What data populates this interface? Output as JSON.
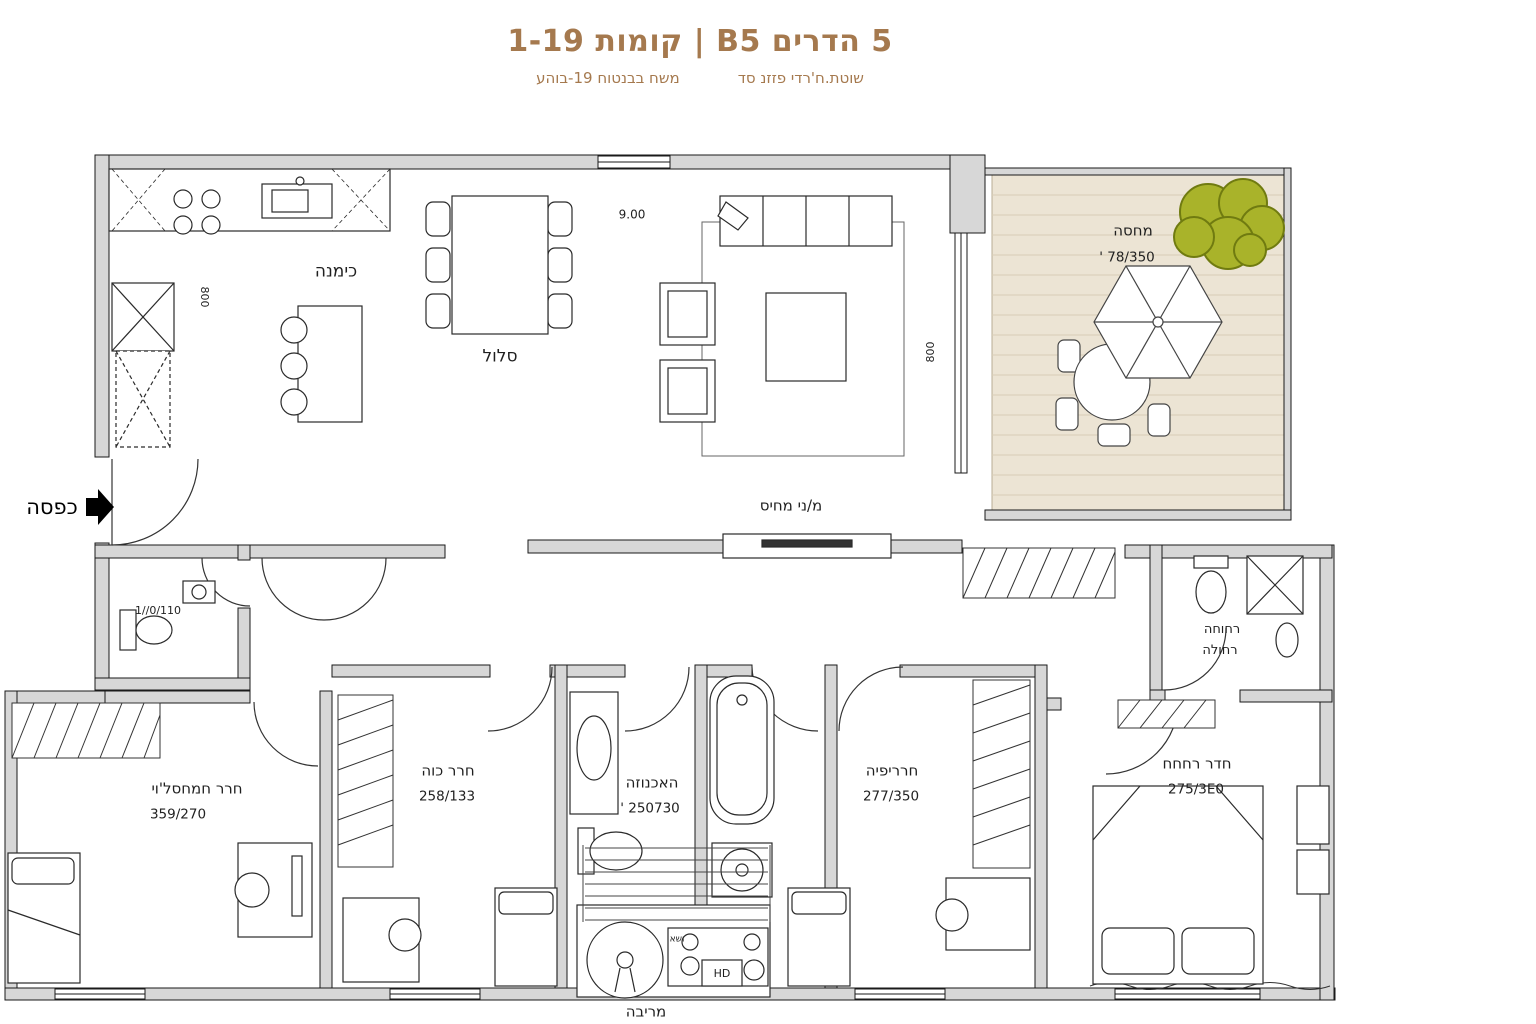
{
  "header": {
    "title": "5 הדרים B5 | קומות 1-19",
    "subtitle_right": "שוטת.ח'רדי פזזנ סד",
    "subtitle_left": "משח בבנטוח 19-בוהע"
  },
  "entrance": {
    "label": "כפסה"
  },
  "rooms": {
    "kitchen": {
      "label": "כימנה"
    },
    "dining": {
      "label": "סלול"
    },
    "living": {
      "label": "מ/ני מחיס"
    },
    "balcony": {
      "label": "מחסה",
      "dim": "78/350 '"
    },
    "toilet": {
      "dim": "1//0/110"
    },
    "bedroom_main": {
      "label": "חרר חמחסל'וי",
      "dim": "359/270"
    },
    "bedroom_2": {
      "label": "חרר כוה",
      "dim": "258/133"
    },
    "bathroom_central": {
      "label": "האכנוזה",
      "dim": "250730 '"
    },
    "bedroom_3": {
      "label": "חרריפיה",
      "dim": "277/350"
    },
    "bedroom_4": {
      "label": "חדר רחחח",
      "dim": "275/3E0"
    },
    "bathroom_top_right": {
      "label_line1": "רחוחה",
      "label_line2": "רחולה"
    },
    "laundry": {
      "label": "מריבה",
      "small_label": "ושא",
      "appliance_label": "HD"
    }
  },
  "dimensions": {
    "top_width": "9.00",
    "left_height": "800",
    "right_height": "800"
  },
  "colors": {
    "accent": "#a5794e",
    "wall": "#d7d7d7",
    "deck": "#ece4d4",
    "tree": "#a9b32a"
  }
}
